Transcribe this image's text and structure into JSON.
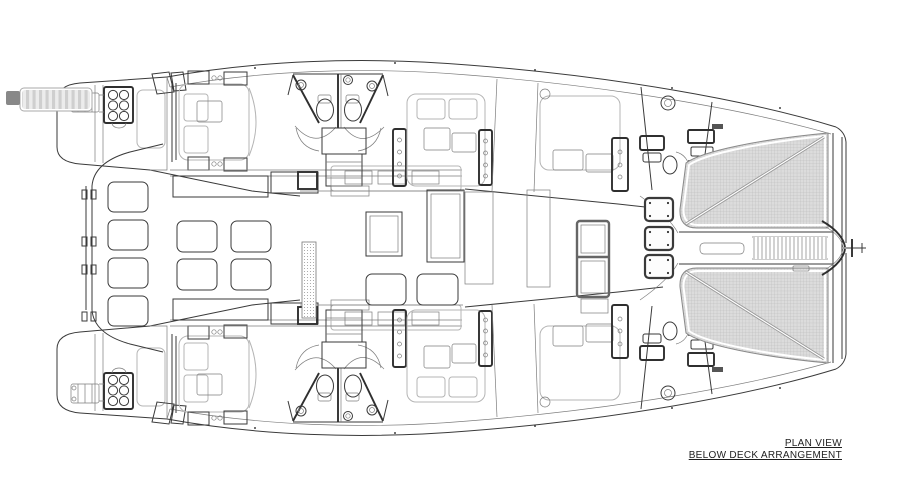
{
  "title_block": {
    "line1": "PLAN VIEW",
    "line2": "BELOW DECK ARRANGEMENT"
  },
  "diagram": {
    "type": "boat-floor-plan",
    "subject": "catamaran below-deck arrangement, plan view, bow right / stern left"
  },
  "colors": {
    "paper": "#ffffff",
    "line": "#3a3a3a",
    "line_light": "#7d7d7d",
    "furniture": "#b5b5b5",
    "trampoline_fill": "#dcdcdc",
    "trampoline_grid": "#b6b6b6",
    "text": "#1f1f1f"
  }
}
